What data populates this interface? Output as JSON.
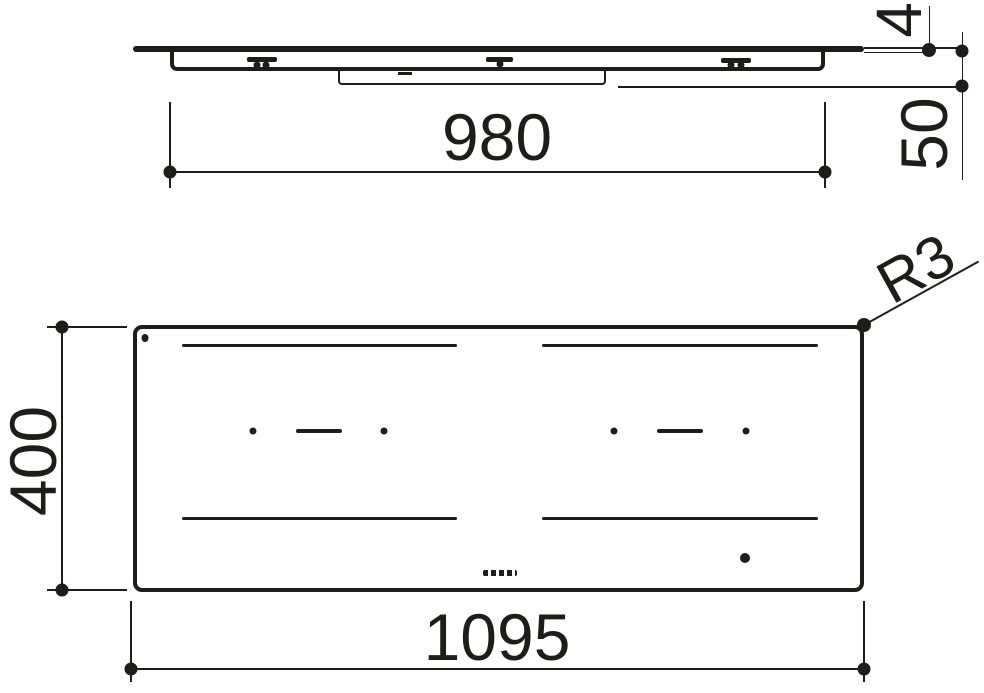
{
  "colors": {
    "ink": "#1d1d1b",
    "paper": "#ffffff"
  },
  "side_view": {
    "dim_body_width": "980",
    "dim_glass_thickness": "4",
    "dim_installation_depth": "50"
  },
  "plan_view": {
    "dim_overall_width": "1095",
    "dim_overall_depth": "400",
    "corner_radius_label": "R3"
  }
}
